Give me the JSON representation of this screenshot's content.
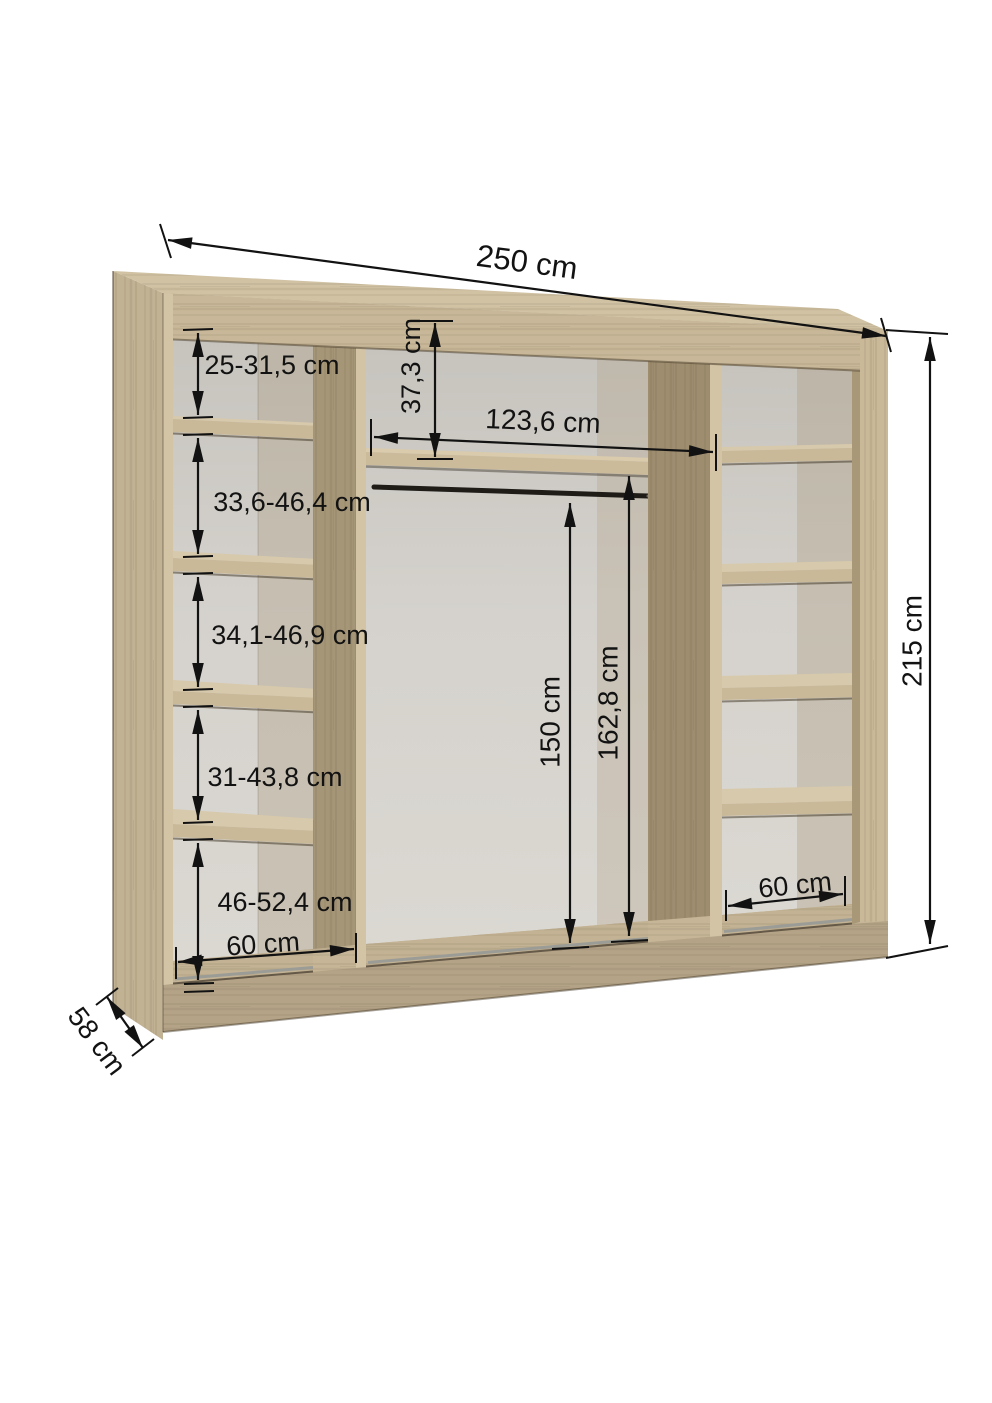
{
  "overall": {
    "width": "250 cm",
    "height": "215 cm",
    "depth": "58 cm"
  },
  "left_column": {
    "compartments": [
      "25-31,5 cm",
      "33,6-46,4 cm",
      "34,1-46,9 cm",
      "31-43,8 cm",
      "46-52,4 cm"
    ],
    "width": "60 cm"
  },
  "middle": {
    "top_offset": "37,3 cm",
    "inner_width": "123,6 cm",
    "rail_height": "150 cm",
    "shelf_height": "162,8 cm"
  },
  "right_column": {
    "width": "60 cm"
  },
  "colors": {
    "wood_front": "#c6b697",
    "wood_edge": "#d3c4a5",
    "wood_side": "#a69678",
    "back_panel": "#d2cfca",
    "dimension_ink": "#121212",
    "background": "#ffffff"
  }
}
